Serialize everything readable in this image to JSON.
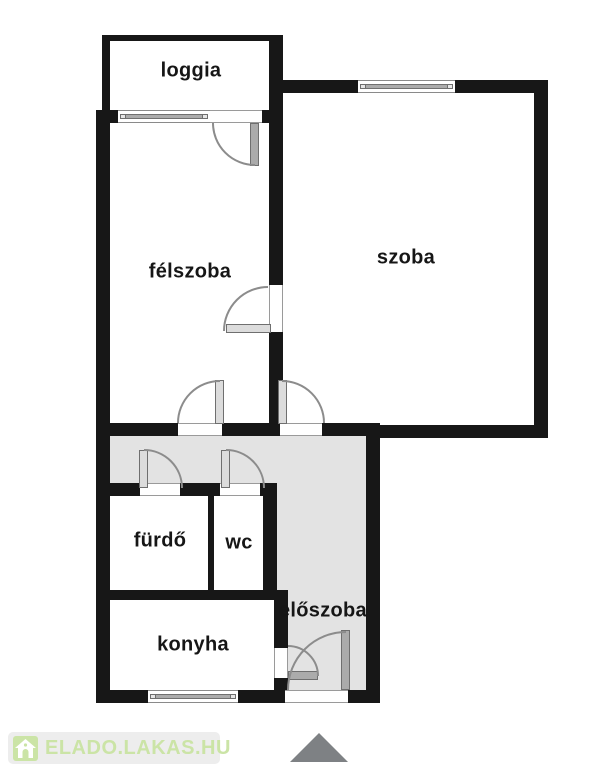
{
  "rooms": [
    {
      "id": "loggia",
      "label": "loggia"
    },
    {
      "id": "felszoba",
      "label": "félszoba"
    },
    {
      "id": "szoba",
      "label": "szoba"
    },
    {
      "id": "furdo",
      "label": "fürdő"
    },
    {
      "id": "wc",
      "label": "wc"
    },
    {
      "id": "konyha",
      "label": "konyha"
    },
    {
      "id": "eloszoba",
      "label": "előszoba"
    }
  ],
  "branding": {
    "site_name": "ELADO.LAKAS.HU",
    "logo_icon": "house-icon"
  },
  "compass": {
    "shape": "triangle-up"
  },
  "colors": {
    "wall": "#171717",
    "hall-floor": "#e3e3e3",
    "room-floor": "#ffffff",
    "fixture": "#ababab",
    "fixture-border": "#6f6f6f",
    "arc": "#8c8c8c",
    "brand": "#cbe4a6",
    "badge-bg": "#ededed",
    "compass-fill": "#7e8184"
  }
}
